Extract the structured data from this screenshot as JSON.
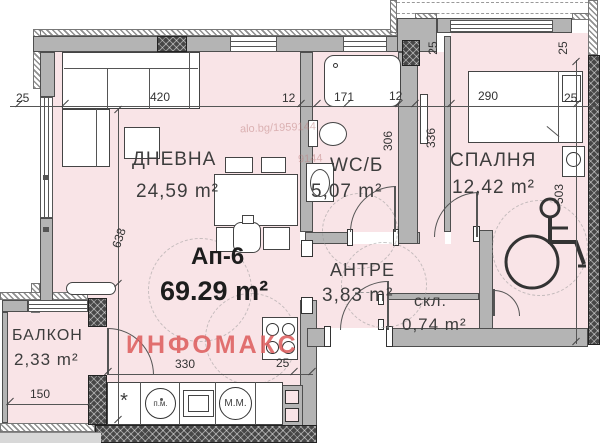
{
  "apartment": {
    "name": "Ап-6",
    "area": "69.29 m²"
  },
  "rooms": {
    "living": {
      "name": "ДНЕВНА",
      "area": "24,59 m²"
    },
    "wc": {
      "name": "WC/Б",
      "area": "5,07 m²"
    },
    "bedroom": {
      "name": "СПАЛНЯ",
      "area": "12,42 m²"
    },
    "hall": {
      "name": "АНТРЕ",
      "area": "3,83 m²"
    },
    "storage": {
      "name": "скл.",
      "area": "0,74 m²"
    },
    "balcony": {
      "name": "БАЛКОН",
      "area": "2,33 m²"
    }
  },
  "dimensions": {
    "top_left_25": "25",
    "top_420": "420",
    "top_12_a": "12",
    "top_171": "171",
    "top_12_b": "12",
    "top_290": "290",
    "top_right_25": "25",
    "bed_left_25": "25",
    "bed_right_25": "25",
    "wc_306": "306",
    "corr_336": "336",
    "bed_503": "503",
    "living_638": "638",
    "kitchen_330": "330",
    "kitchen_25": "25",
    "balcony_150": "150"
  },
  "appliances": {
    "washing_machine": "п.м.",
    "dishwasher": "М.М.",
    "star_marker": "*"
  },
  "watermarks": {
    "brand": "ИНФОМАКС",
    "listing": "alo.bg/1959144",
    "listing_fragment": "9144"
  },
  "colors": {
    "room_fill": "#f9e4e7",
    "wall_gray": "#b4b4b4",
    "brand_red": "#dd5f5f"
  }
}
